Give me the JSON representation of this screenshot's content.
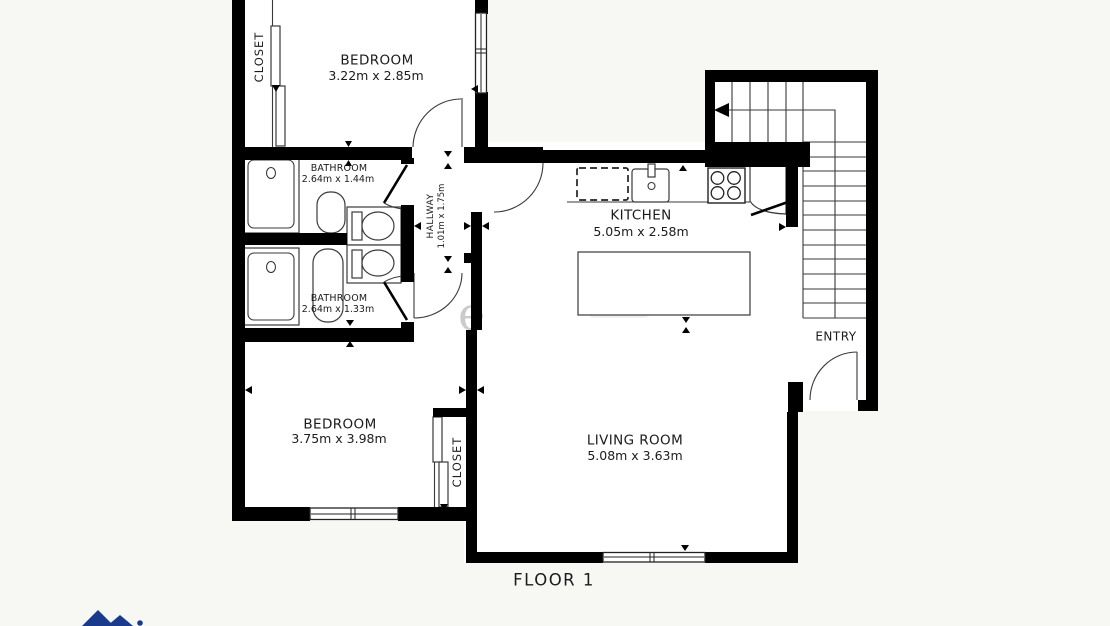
{
  "floor_plan": {
    "title": "FLOOR 1",
    "watermark_fragment": "e",
    "rooms": [
      {
        "name": "BEDROOM",
        "dimensions": "3.22m x 2.85m"
      },
      {
        "name": "CLOSET"
      },
      {
        "name": "BATHROOM",
        "dimensions": "2.64m x 1.44m"
      },
      {
        "name": "HALLWAY",
        "dimensions": "1.01m x 1.75m"
      },
      {
        "name": "BATHROOM",
        "dimensions": "2.64m x 1.33m"
      },
      {
        "name": "KITCHEN",
        "dimensions": "5.05m x 2.58m"
      },
      {
        "name": "BEDROOM",
        "dimensions": "3.75m x 3.98m"
      },
      {
        "name": "CLOSET"
      },
      {
        "name": "LIVING ROOM",
        "dimensions": "5.08m x 3.63m"
      },
      {
        "name": "ENTRY"
      }
    ],
    "colors": {
      "wall": "#000000",
      "line": "#3a3a3a",
      "background": "#f7f7f4",
      "room": "#ffffff",
      "text": "#1b1b1b",
      "logo_blue": "#1b3a8c"
    }
  }
}
